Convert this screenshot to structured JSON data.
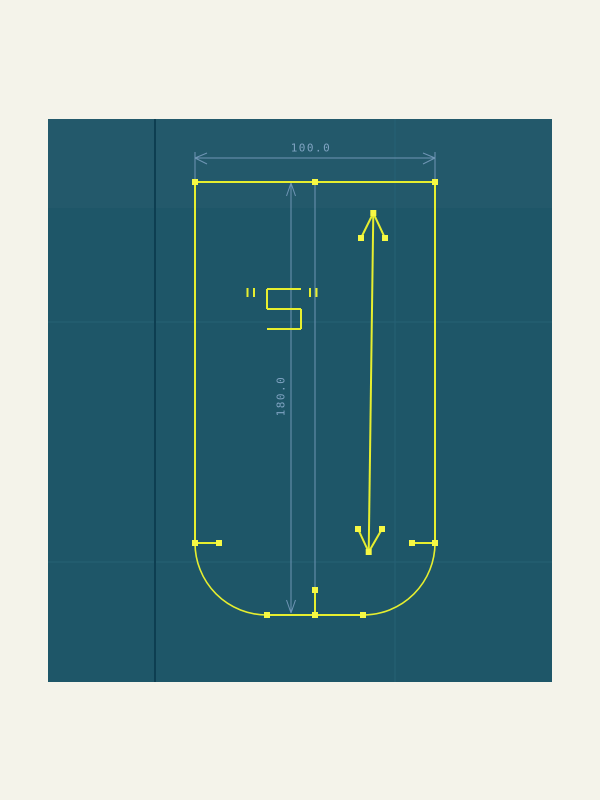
{
  "app": {
    "description": "CAD sketch viewport",
    "background_color": "#f4f3ea"
  },
  "colors": {
    "canvas_bg": "#1e5668",
    "canvas_top_band": "rgba(255,255,255,0.025)",
    "grid_dark_line": "#0d3e51",
    "grid_faint_line": "#27617526",
    "grid_faint_line_solid": "#266175",
    "sketch_line": "#e6ee2f",
    "vertex_handle": "#f6f844",
    "dimension_line": "#6f95b5",
    "dimension_text": "#7fa3c2"
  },
  "viewport": {
    "x": 48,
    "y": 119,
    "width": 504,
    "height": 563
  },
  "grid": {
    "dark_vline_x": 155,
    "faint_vlines_x": [
      395
    ],
    "faint_hlines_y": [
      322,
      562
    ],
    "top_band_bottom_y": 208
  },
  "sketch": {
    "outline_lines": [
      [
        195,
        182,
        435,
        182
      ],
      [
        195,
        182,
        195,
        543
      ],
      [
        435,
        182,
        435,
        543
      ],
      [
        267,
        615,
        363,
        615
      ]
    ],
    "arcs": [
      {
        "cx": 267,
        "cy": 543,
        "r": 72,
        "start": 180,
        "end": 90,
        "sweep": 0
      },
      {
        "cx": 363,
        "cy": 543,
        "r": 72,
        "start": 90,
        "end": 0,
        "sweep": 0
      }
    ],
    "stub_lines": [
      [
        195,
        543,
        219,
        543
      ],
      [
        412,
        543,
        435,
        543
      ],
      [
        315,
        590,
        315,
        615
      ]
    ],
    "arrow_lines": [
      [
        373.3,
        213,
        368.7,
        552
      ],
      [
        373.3,
        213,
        361,
        238
      ],
      [
        373.3,
        213,
        385,
        238
      ],
      [
        368.7,
        552,
        358,
        529
      ],
      [
        368.7,
        552,
        382,
        529
      ]
    ],
    "vertices": [
      [
        195,
        182
      ],
      [
        315,
        182
      ],
      [
        435,
        182
      ],
      [
        195,
        543
      ],
      [
        219,
        543
      ],
      [
        412,
        543
      ],
      [
        435,
        543
      ],
      [
        267,
        615
      ],
      [
        315,
        615
      ],
      [
        363,
        615
      ],
      [
        315,
        590
      ],
      [
        373.3,
        213
      ],
      [
        361,
        238
      ],
      [
        385,
        238
      ],
      [
        368.7,
        552
      ],
      [
        358,
        529
      ],
      [
        382,
        529
      ]
    ],
    "vertex_size": 6
  },
  "annotation": {
    "text": "\"S\"",
    "glyph_segments": [
      [
        267,
        289,
        301,
        289
      ],
      [
        267,
        289,
        267,
        309
      ],
      [
        267,
        309,
        301,
        309
      ],
      [
        301,
        309,
        301,
        329
      ],
      [
        267,
        329,
        301,
        329
      ],
      [
        247.5,
        288,
        247.5,
        297
      ],
      [
        254,
        288,
        254,
        297
      ],
      [
        310,
        288,
        310,
        297
      ],
      [
        316.5,
        288,
        316.5,
        297
      ]
    ]
  },
  "dimensions": {
    "horizontal": {
      "label": "100.0",
      "label_center": [
        311,
        148
      ],
      "line": [
        195,
        158,
        435,
        158
      ],
      "extension_lines": [
        [
          195,
          152,
          195,
          180
        ],
        [
          435,
          152,
          435,
          180
        ]
      ],
      "arrow_segments": [
        [
          195,
          158,
          207,
          153
        ],
        [
          195,
          158,
          207,
          164
        ],
        [
          435,
          158,
          423,
          153
        ],
        [
          435,
          158,
          423,
          164
        ]
      ]
    },
    "vertical": {
      "label": "180.0",
      "label_center": [
        281,
        396
      ],
      "line": [
        291,
        183,
        291,
        613
      ],
      "extension_lines": [],
      "arrow_segments": [
        [
          291,
          183,
          286.5,
          196
        ],
        [
          291,
          183,
          295.5,
          196
        ],
        [
          291,
          613,
          286.5,
          600
        ],
        [
          291,
          613,
          295.5,
          600
        ]
      ]
    },
    "reference_line": [
      315,
      183,
      315,
      589
    ]
  }
}
